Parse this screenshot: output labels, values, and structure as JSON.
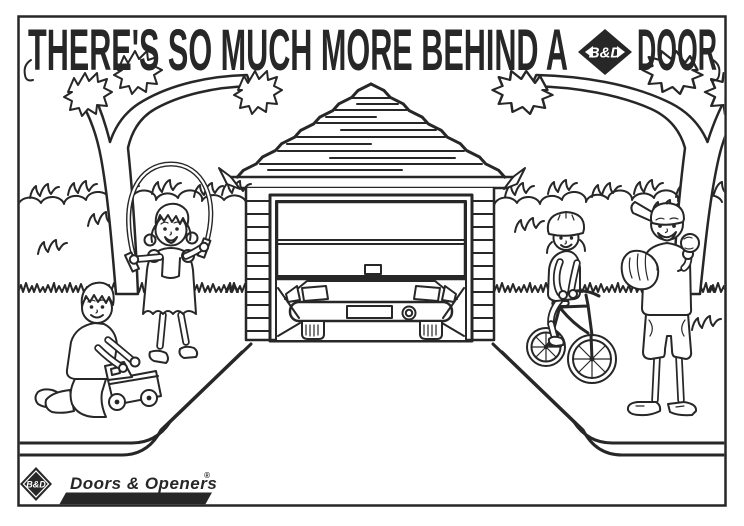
{
  "headline": {
    "part1": "THERE'S SO MUCH MORE BEHIND A",
    "part2": "DOOR",
    "logo_text": "B&D"
  },
  "footer": {
    "logo_text": "B&D",
    "brand": "Doors & Openers",
    "registered": "®"
  },
  "colors": {
    "ink": "#272727",
    "paper": "#ffffff"
  },
  "scene": {
    "type": "coloring-page line art",
    "elements": [
      "tree-left",
      "tree-right",
      "hedge-with-grass",
      "garage-with-open-sectional-door",
      "car-parked-inside-garage",
      "flared-driveway",
      "boy-playing-with-toy-truck",
      "girl-skipping-rope",
      "child-riding-bicycle-with-helmet",
      "boy-with-baseball-glove-and-ball"
    ]
  }
}
